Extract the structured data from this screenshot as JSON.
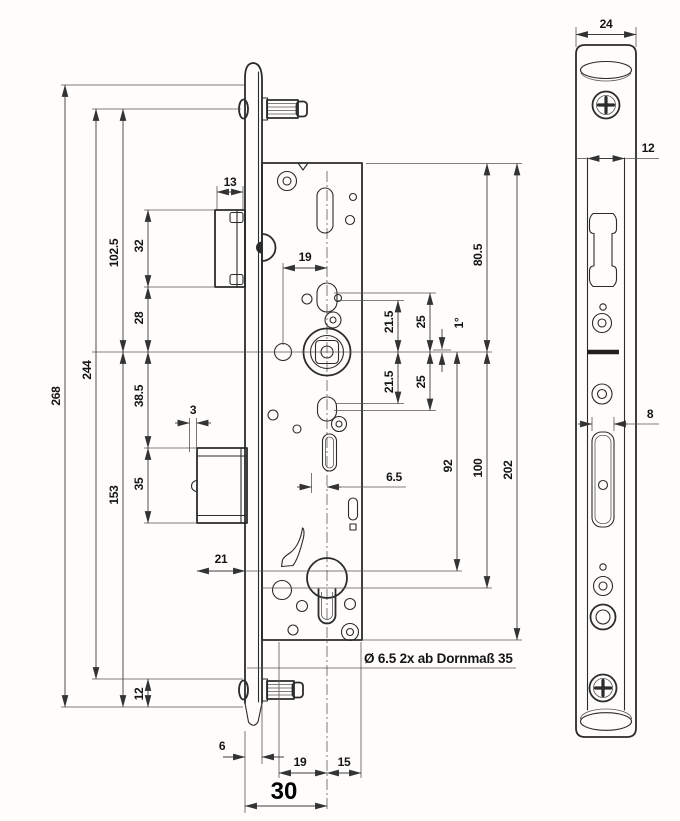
{
  "title": "Mortise lock technical drawing (two views)",
  "colors": {
    "line": "#2b2b2b",
    "dim": "#3c3c3c",
    "text": "#151515",
    "bg": "#ffffff"
  },
  "views": {
    "left": "lock case side view",
    "right": "faceplate front view"
  },
  "note": "Ø 6.5 2x ab Dornmaß 35",
  "dims": {
    "total_height": "268",
    "pin_spacing": "244",
    "top_to_follower": "102.5",
    "follower_to_bottom": "153",
    "latch_height": "32",
    "latch_to_follower": "28",
    "follower_to_bolt": "38.5",
    "bolt_height": "35",
    "bottom_margin": "12",
    "latch_depth": "13",
    "bolt_pin_width": "3",
    "bolt_depth": "21",
    "plate_offset": "6",
    "follower_hole_offset": "19",
    "cyl_left": "19",
    "cyl_right": "15",
    "backset": "30",
    "upper_21_5": "21.5",
    "upper_25": "25",
    "lower_21_5": "21.5",
    "lower_25": "25",
    "angle": "1°",
    "case_top_to_follower": "80.5",
    "follower_to_hole": "92",
    "follower_to_cyl": "100",
    "case_height": "202",
    "slot_offset": "6.5",
    "fp_width": "24",
    "fp_channel": "12",
    "fp_slot": "8"
  }
}
